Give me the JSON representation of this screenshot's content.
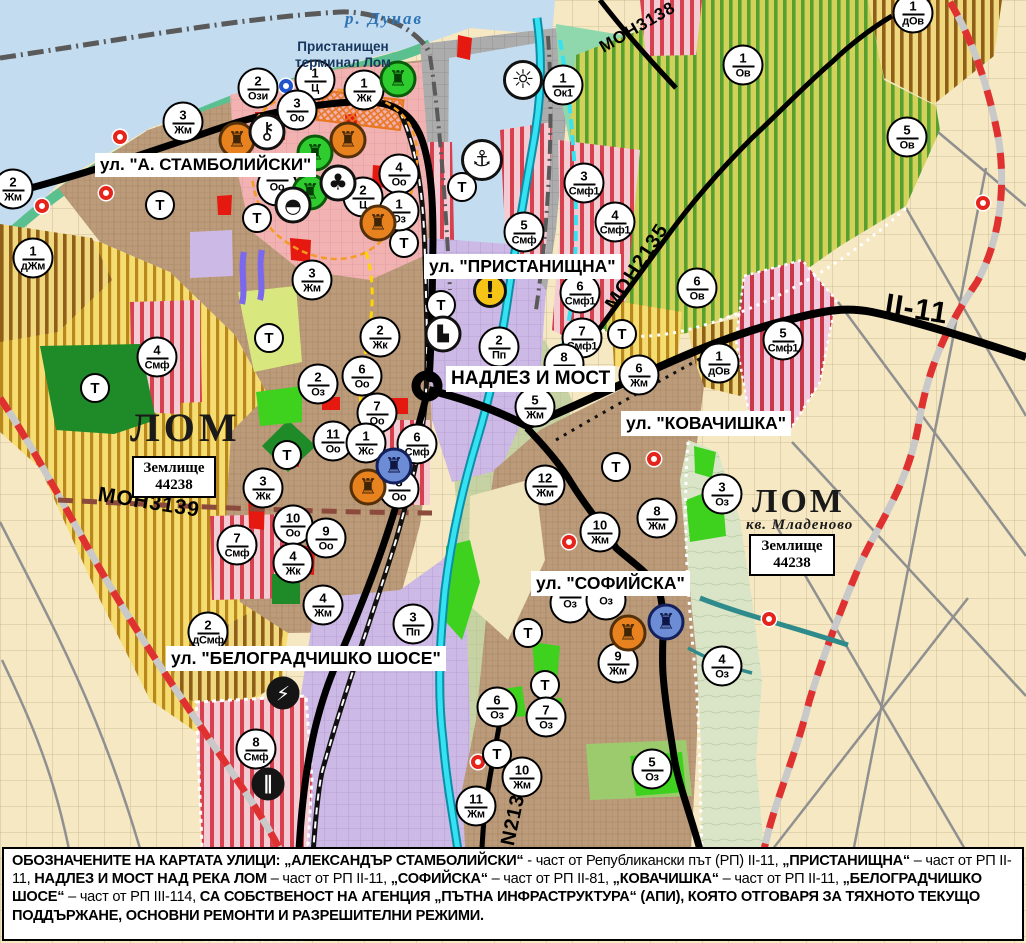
{
  "t_label": "Т",
  "palette": {
    "residential_brown": "#BB9B79",
    "center_pink": "#F2B2B2",
    "villa_yellow_stripe": "#B9881C",
    "orchard_green_stripe": "#57A02F",
    "smf_red_stripe": "#D7404E",
    "industrial_purple": "#CDB9E5",
    "port_gray": "#ACACAC",
    "danube_water": "#C3DCF0",
    "river_cyan": "#35E2F2",
    "park_green": "#3ED21F",
    "agri_cream": "#F5E8C2",
    "boundary_red": "#E03131",
    "road_black": "#000000"
  },
  "labels": {
    "river": "р. Дунав",
    "terminal": "Пристанищен\nтерминал Лом",
    "district": "кв. Младеново",
    "streets": [
      {
        "text": "ул. \"А. СТАМБОЛИЙСКИ\"",
        "x": 95,
        "y": 153,
        "fs": 17,
        "name": "street-label-stamboliyski"
      },
      {
        "text": "ул. \"ПРИСТАНИЩНА\"",
        "x": 424,
        "y": 254,
        "fs": 17.5,
        "name": "street-label-pristanishtna"
      },
      {
        "text": "НАДЛЕЗ И МОСТ",
        "x": 446,
        "y": 366,
        "fs": 19,
        "name": "street-label-nadlez-i-most"
      },
      {
        "text": "ул. \"КОВАЧИШКА\"",
        "x": 621,
        "y": 411,
        "fs": 17.5,
        "name": "street-label-kovachishka"
      },
      {
        "text": "ул. \"СОФИЙСКА\"",
        "x": 531,
        "y": 571,
        "fs": 17.5,
        "name": "street-label-sofiyska"
      },
      {
        "text": "ул. \"БЕЛОГРАДЧИШКО ШОСЕ\"",
        "x": 166,
        "y": 646,
        "fs": 17.5,
        "name": "street-label-belogradchishko-shose"
      }
    ],
    "city": [
      {
        "text": "ЛОМ",
        "x": 130,
        "y": 404,
        "fs": 40,
        "ls": 4,
        "name": "city-label-lom"
      },
      {
        "text": "ЛОМ",
        "x": 752,
        "y": 483,
        "fs": 34,
        "ls": 3,
        "name": "city-label-lom-mladenovo"
      }
    ],
    "roads": [
      {
        "text": "МОН3139",
        "x": 100,
        "y": 483,
        "rot": 9,
        "fs": 21,
        "name": "road-label-mon3139"
      },
      {
        "text": "МОН2135",
        "x": 601,
        "y": 302,
        "rot": -57,
        "fs": 20,
        "name": "road-label-mon2135"
      },
      {
        "text": "МОН3138",
        "x": 596,
        "y": 40,
        "rot": -30,
        "fs": 17,
        "name": "road-label-mon3138"
      },
      {
        "text": "II-11",
        "x": 888,
        "y": 288,
        "rot": 9,
        "fs": 30,
        "name": "road-label-ii-11"
      },
      {
        "text": "N2136",
        "x": 497,
        "y": 843,
        "rot": -78,
        "fs": 20,
        "name": "road-label-n2136"
      }
    ],
    "land_boxes": [
      {
        "l1": "Землище",
        "l2": "44238",
        "x": 132,
        "y": 456,
        "w": 84
      },
      {
        "l1": "Землище",
        "l2": "44238",
        "x": 749,
        "y": 534,
        "w": 86
      }
    ]
  },
  "markers": [
    {
      "x": 13,
      "y": 189,
      "num": "2",
      "zone": "Жм"
    },
    {
      "x": 33,
      "y": 258,
      "num": "1",
      "zone": "дЖм"
    },
    {
      "x": 183,
      "y": 122,
      "num": "3",
      "zone": "Жм"
    },
    {
      "x": 258,
      "y": 88,
      "num": "2",
      "zone": "Ози"
    },
    {
      "x": 315,
      "y": 80,
      "num": "1",
      "zone": "Ц"
    },
    {
      "x": 297,
      "y": 110,
      "num": "3",
      "zone": "Оо"
    },
    {
      "x": 364,
      "y": 90,
      "num": "1",
      "zone": "Жк"
    },
    {
      "x": 399,
      "y": 174,
      "num": "4",
      "zone": "Оо"
    },
    {
      "x": 363,
      "y": 197,
      "num": "2",
      "zone": "Ц"
    },
    {
      "x": 399,
      "y": 211,
      "num": "1",
      "zone": "Оз"
    },
    {
      "x": 277,
      "y": 186,
      "num": "",
      "zone": "Оо"
    },
    {
      "x": 524,
      "y": 232,
      "num": "5",
      "zone": "Смф"
    },
    {
      "x": 563,
      "y": 85,
      "num": "1",
      "zone": "Ок1"
    },
    {
      "x": 584,
      "y": 183,
      "num": "3",
      "zone": "Смф1"
    },
    {
      "x": 615,
      "y": 222,
      "num": "4",
      "zone": "Смф1"
    },
    {
      "x": 743,
      "y": 65,
      "num": "1",
      "zone": "Ов"
    },
    {
      "x": 907,
      "y": 137,
      "num": "5",
      "zone": "Ов"
    },
    {
      "x": 913,
      "y": 13,
      "num": "1",
      "zone": "дОв"
    },
    {
      "x": 697,
      "y": 288,
      "num": "6",
      "zone": "Ов"
    },
    {
      "x": 580,
      "y": 293,
      "num": "6",
      "zone": "Смф1"
    },
    {
      "x": 582,
      "y": 338,
      "num": "7",
      "zone": "Смф1"
    },
    {
      "x": 783,
      "y": 340,
      "num": "5",
      "zone": "Смф1"
    },
    {
      "x": 719,
      "y": 363,
      "num": "1",
      "zone": "дОв"
    },
    {
      "x": 639,
      "y": 375,
      "num": "6",
      "zone": "Жм"
    },
    {
      "x": 499,
      "y": 347,
      "num": "2",
      "zone": "Пп"
    },
    {
      "x": 535,
      "y": 407,
      "num": "5",
      "zone": "Жм"
    },
    {
      "x": 564,
      "y": 364,
      "num": "8",
      "zone": "Жм"
    },
    {
      "x": 545,
      "y": 485,
      "num": "12",
      "zone": "Жм"
    },
    {
      "x": 417,
      "y": 444,
      "num": "6",
      "zone": "Смф"
    },
    {
      "x": 600,
      "y": 532,
      "num": "10",
      "zone": "Жм"
    },
    {
      "x": 657,
      "y": 518,
      "num": "8",
      "zone": "Жм"
    },
    {
      "x": 722,
      "y": 494,
      "num": "3",
      "zone": "Оз"
    },
    {
      "x": 618,
      "y": 663,
      "num": "9",
      "zone": "Жм"
    },
    {
      "x": 722,
      "y": 666,
      "num": "4",
      "zone": "Оз"
    },
    {
      "x": 497,
      "y": 707,
      "num": "6",
      "zone": "Оз"
    },
    {
      "x": 546,
      "y": 717,
      "num": "7",
      "zone": "Оз"
    },
    {
      "x": 652,
      "y": 769,
      "num": "5",
      "zone": "Оз"
    },
    {
      "x": 522,
      "y": 777,
      "num": "10",
      "zone": "Жм"
    },
    {
      "x": 476,
      "y": 806,
      "num": "11",
      "zone": "Жм"
    },
    {
      "x": 570,
      "y": 603,
      "num": "",
      "zone": "Оз"
    },
    {
      "x": 606,
      "y": 600,
      "num": "",
      "zone": "Оз"
    },
    {
      "x": 312,
      "y": 280,
      "num": "3",
      "zone": "Жм"
    },
    {
      "x": 157,
      "y": 357,
      "num": "4",
      "zone": "Смф"
    },
    {
      "x": 318,
      "y": 384,
      "num": "2",
      "zone": "Оз"
    },
    {
      "x": 362,
      "y": 376,
      "num": "6",
      "zone": "Оо"
    },
    {
      "x": 377,
      "y": 413,
      "num": "7",
      "zone": "Оо"
    },
    {
      "x": 333,
      "y": 441,
      "num": "11",
      "zone": "Оо"
    },
    {
      "x": 366,
      "y": 443,
      "num": "1",
      "zone": "Жс"
    },
    {
      "x": 263,
      "y": 488,
      "num": "3",
      "zone": "Жк"
    },
    {
      "x": 293,
      "y": 525,
      "num": "10",
      "zone": "Оо"
    },
    {
      "x": 326,
      "y": 538,
      "num": "9",
      "zone": "Оо"
    },
    {
      "x": 399,
      "y": 489,
      "num": "8",
      "zone": "Оо"
    },
    {
      "x": 293,
      "y": 563,
      "num": "4",
      "zone": "Жк"
    },
    {
      "x": 323,
      "y": 605,
      "num": "4",
      "zone": "Жм"
    },
    {
      "x": 237,
      "y": 545,
      "num": "7",
      "zone": "Смф"
    },
    {
      "x": 380,
      "y": 337,
      "num": "2",
      "zone": "Жк"
    },
    {
      "x": 208,
      "y": 632,
      "num": "2",
      "zone": "дСмф"
    },
    {
      "x": 413,
      "y": 624,
      "num": "3",
      "zone": "Пп"
    },
    {
      "x": 256,
      "y": 749,
      "num": "8",
      "zone": "Смф"
    }
  ],
  "t_markers": [
    {
      "x": 160,
      "y": 205
    },
    {
      "x": 257,
      "y": 218
    },
    {
      "x": 404,
      "y": 243
    },
    {
      "x": 462,
      "y": 187
    },
    {
      "x": 95,
      "y": 388
    },
    {
      "x": 269,
      "y": 338
    },
    {
      "x": 287,
      "y": 455
    },
    {
      "x": 441,
      "y": 305
    },
    {
      "x": 622,
      "y": 334
    },
    {
      "x": 616,
      "y": 467
    },
    {
      "x": 528,
      "y": 633
    },
    {
      "x": 545,
      "y": 685
    },
    {
      "x": 497,
      "y": 754
    }
  ],
  "icons": [
    {
      "name": "monument-icon-green",
      "x": 398,
      "y": 79,
      "bg": "#2ECC2E",
      "bc": "#0A5A0A",
      "fg": "#063F06",
      "glyph": "♜",
      "fs": 21
    },
    {
      "name": "monument-icon-green",
      "x": 315,
      "y": 153,
      "bg": "#2ECC2E",
      "bc": "#0A5A0A",
      "fg": "#063F06",
      "glyph": "♜",
      "fs": 21
    },
    {
      "name": "monument-icon-green",
      "x": 310,
      "y": 192,
      "bg": "#2ECC2E",
      "bc": "#0A5A0A",
      "fg": "#063F06",
      "glyph": "♜",
      "fs": 21
    },
    {
      "name": "monument-icon-orange",
      "x": 237,
      "y": 140,
      "bg": "#E8821E",
      "bc": "#53300A",
      "fg": "#3F2405",
      "glyph": "♜",
      "fs": 21
    },
    {
      "name": "monument-icon-orange",
      "x": 348,
      "y": 140,
      "bg": "#E8821E",
      "bc": "#53300A",
      "fg": "#3F2405",
      "glyph": "♜",
      "fs": 21
    },
    {
      "name": "monument-icon-orange",
      "x": 378,
      "y": 223,
      "bg": "#E8821E",
      "bc": "#53300A",
      "fg": "#3F2405",
      "glyph": "♜",
      "fs": 21
    },
    {
      "name": "monument-icon-orange",
      "x": 368,
      "y": 487,
      "bg": "#E8821E",
      "bc": "#53300A",
      "fg": "#3F2405",
      "glyph": "♜",
      "fs": 21
    },
    {
      "name": "monument-icon-orange",
      "x": 628,
      "y": 633,
      "bg": "#E8821E",
      "bc": "#53300A",
      "fg": "#3F2405",
      "glyph": "♜",
      "fs": 21
    },
    {
      "name": "monument-icon-blue",
      "x": 394,
      "y": 466,
      "bg": "#6C8CD5",
      "bc": "#14205C",
      "fg": "#0D1644",
      "glyph": "♜",
      "fs": 21
    },
    {
      "name": "monument-icon-blue",
      "x": 666,
      "y": 622,
      "bg": "#6C8CD5",
      "bc": "#14205C",
      "fg": "#0D1644",
      "glyph": "♜",
      "fs": 21
    },
    {
      "name": "key-icon",
      "x": 267,
      "y": 132,
      "bg": "#FFFFFF",
      "bc": "#111111",
      "fg": "#111111",
      "glyph": "⚷",
      "fs": 23
    },
    {
      "name": "trefoil-icon",
      "x": 338,
      "y": 183,
      "bg": "#FFFFFF",
      "bc": "#111111",
      "fg": "#111111",
      "glyph": "♣",
      "fs": 22
    },
    {
      "name": "tumulus-icon",
      "x": 293,
      "y": 205,
      "bg": "#FFFFFF",
      "bc": "#111111",
      "fg": "#111111",
      "glyph": "◓",
      "fs": 20
    },
    {
      "name": "anchor-icon",
      "x": 482,
      "y": 160,
      "bg": "#FFFFFF",
      "bc": "#111111",
      "fg": "#111111",
      "glyph": "⚓",
      "fs": 22,
      "d": 42
    },
    {
      "name": "sun-icon",
      "x": 523,
      "y": 80,
      "bg": "#FFFFFF",
      "bc": "#111111",
      "fg": "#111111",
      "glyph": "☼",
      "fs": 26,
      "d": 40
    },
    {
      "name": "warning-icon",
      "x": 490,
      "y": 291,
      "bg": "#F6C417",
      "bc": "#111111",
      "fg": "#111111",
      "glyph": "!",
      "fs": 23,
      "d": 34
    },
    {
      "name": "truck-icon",
      "x": 443,
      "y": 334,
      "bg": "#FFFFFF",
      "bc": "#111111",
      "fg": "#111111",
      "glyph": "▙",
      "fs": 15
    },
    {
      "name": "lightning-icon",
      "x": 283,
      "y": 693,
      "bg": "#151515",
      "bc": "#151515",
      "fg": "#FFFFFF",
      "glyph": "⚡",
      "fs": 20,
      "d": 33
    },
    {
      "name": "rail-crossing-icon",
      "x": 268,
      "y": 784,
      "bg": "#151515",
      "bc": "#151515",
      "fg": "#FFFFFF",
      "glyph": "∥",
      "fs": 19,
      "d": 33
    }
  ],
  "dots": [
    {
      "x": 120,
      "y": 137
    },
    {
      "x": 106,
      "y": 193
    },
    {
      "x": 42,
      "y": 206
    },
    {
      "x": 983,
      "y": 203
    },
    {
      "x": 769,
      "y": 619
    },
    {
      "x": 654,
      "y": 459
    },
    {
      "x": 569,
      "y": 542
    },
    {
      "x": 478,
      "y": 762
    },
    {
      "x": 286,
      "y": 86,
      "bc": "#2255CC"
    }
  ],
  "caption": {
    "segments": [
      {
        "t": "ОБОЗНАЧЕНИТЕ НА КАРТАТА УЛИЦИ: „АЛЕКСАНДЪР СТАМБОЛИЙСКИ“",
        "b": true
      },
      {
        "t": " - част от Републикански път (РП) II-11, "
      },
      {
        "t": "„ПРИСТАНИЩНА“",
        "b": true
      },
      {
        "t": " – част от РП II-11, "
      },
      {
        "t": "НАДЛЕЗ И МОСТ НАД РЕКА ЛОМ",
        "b": true
      },
      {
        "t": " – част от РП II-11, "
      },
      {
        "t": "„СОФИЙСКА“",
        "b": true
      },
      {
        "t": " – част от РП II-81, "
      },
      {
        "t": "„КОВАЧИШКА“",
        "b": true
      },
      {
        "t": " – част от РП II-11, "
      },
      {
        "t": "„БЕЛОГРАДЧИШКО ШОСЕ“",
        "b": true
      },
      {
        "t": " – част от РП III-114, "
      },
      {
        "t": "СА СОБСТВЕНОСТ НА АГЕНЦИЯ „ПЪТНА ИНФРАСТРУКТУРА“ (АПИ), КОЯТО ОТГОВАРЯ ЗА ТЯХНОТО ТЕКУЩО ПОДДЪРЖАНЕ, ОСНОВНИ РЕМОНТИ И РАЗРЕШИТЕЛНИ РЕЖИМИ.",
        "b": true
      }
    ]
  }
}
